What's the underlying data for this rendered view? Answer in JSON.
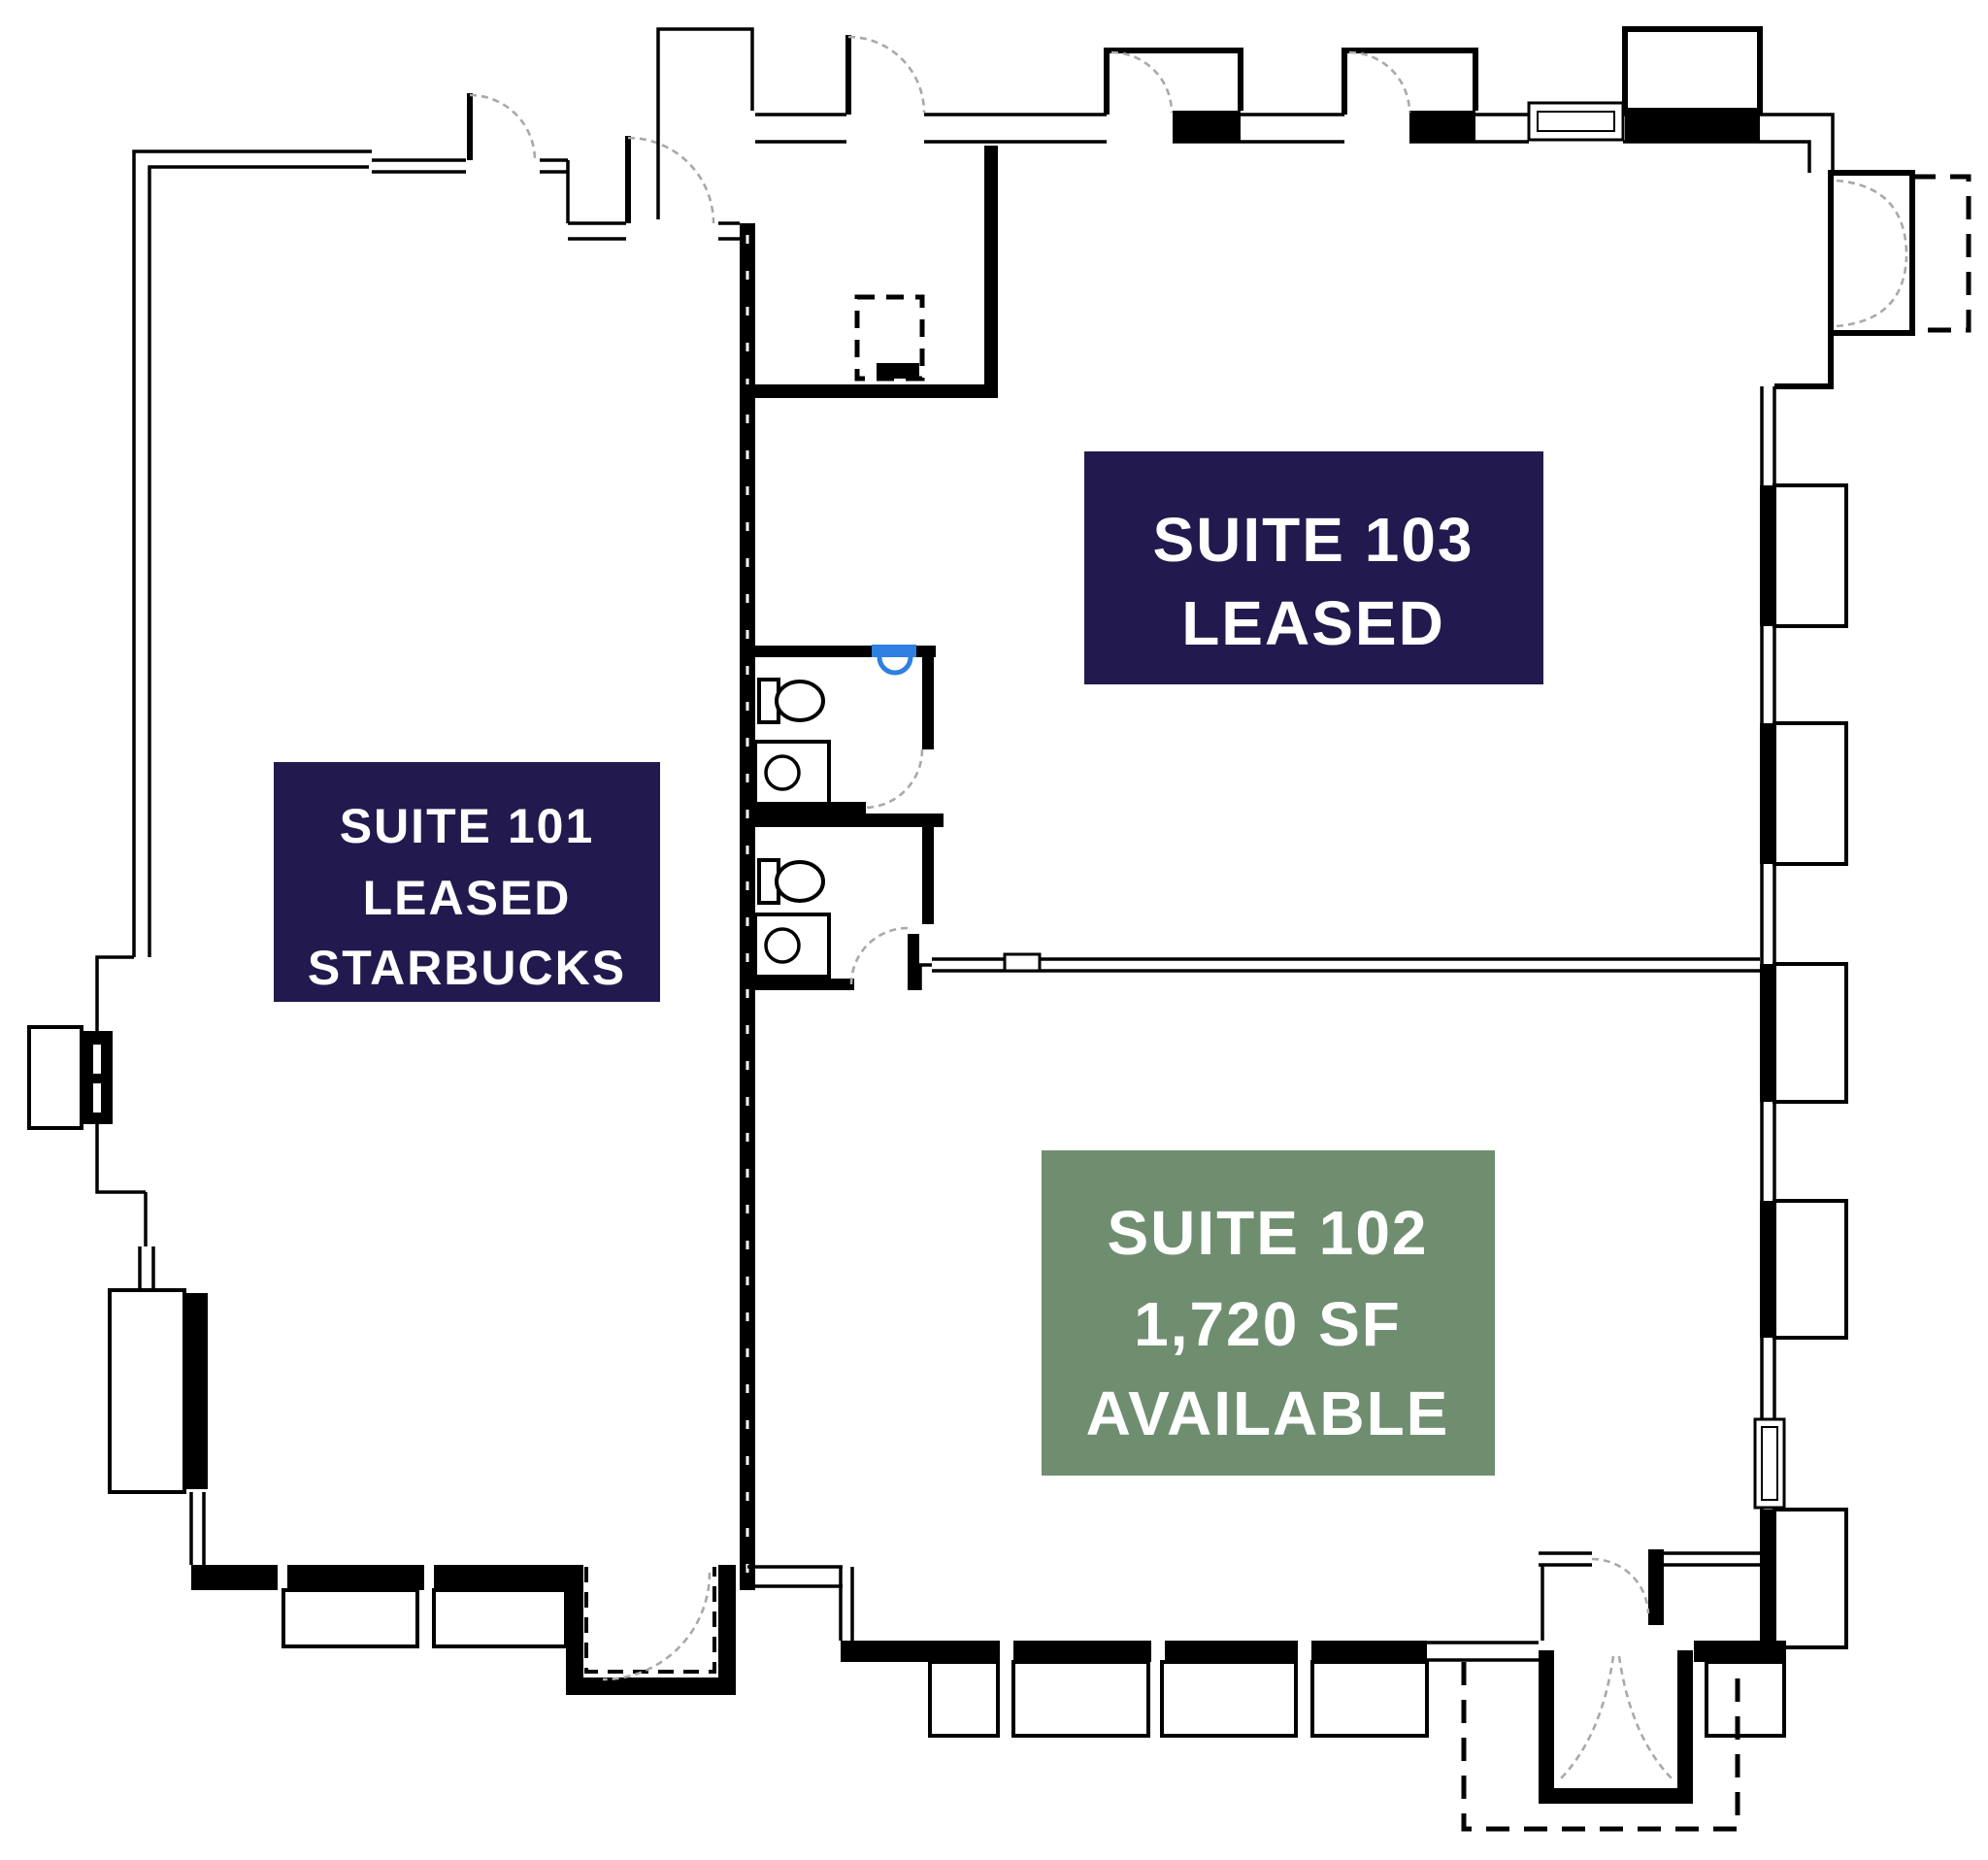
{
  "plan": {
    "type": "commercial-leasing-floor-plan",
    "colors": {
      "leased_box": "#221a4e",
      "available_box": "#6f8e70",
      "label_text": "#ffffff",
      "wall": "#000000",
      "fountain": "#2e7fe0"
    },
    "suites": [
      {
        "id": "101",
        "label": "SUITE 101",
        "status": "LEASED",
        "tenant": "STARBUCKS",
        "box_color_key": "leased_box"
      },
      {
        "id": "103",
        "label": "SUITE 103",
        "status": "LEASED",
        "box_color_key": "leased_box"
      },
      {
        "id": "102",
        "label": "SUITE 102",
        "area": "1,720 SF",
        "status": "AVAILABLE",
        "box_color_key": "available_box"
      }
    ],
    "fixtures": {
      "restrooms": 2,
      "toilets": 2,
      "sinks": 2,
      "drinking_fountains": 1
    }
  }
}
